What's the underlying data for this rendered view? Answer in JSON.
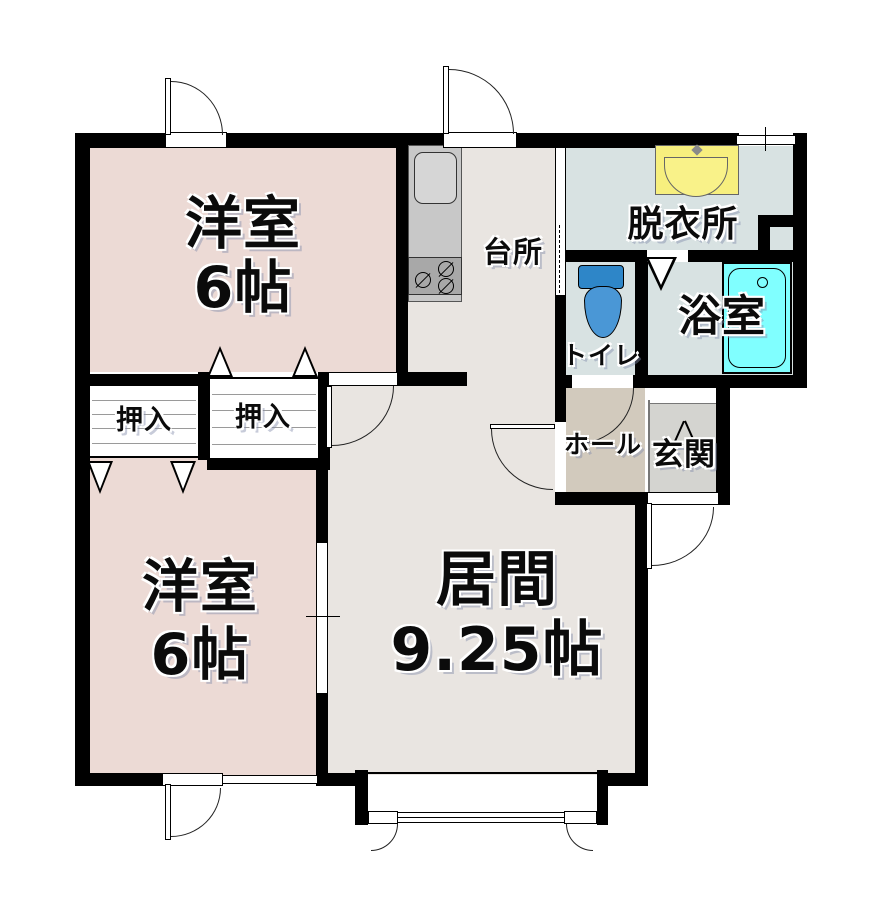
{
  "title": "apartment floor plan",
  "plan_type": "floorplan",
  "rooms": {
    "bedroom_top": {
      "label": "洋室",
      "area": "6帖"
    },
    "bedroom_bottom": {
      "label": "洋室",
      "area": "6帖"
    },
    "living": {
      "label": "居間",
      "area": "9.25帖"
    },
    "kitchen": {
      "label": "台所"
    },
    "dressing": {
      "label": "脱衣所"
    },
    "toilet": {
      "label": "トイレ"
    },
    "bath": {
      "label": "浴室"
    },
    "hall": {
      "label": "ホール"
    },
    "entrance": {
      "label": "玄関"
    },
    "closet_upper": {
      "label": "押入"
    },
    "closet_lower": {
      "label": "押入"
    }
  },
  "fixtures": [
    "kitchen-sink",
    "gas-stove",
    "washbasin",
    "toilet-bowl",
    "bathtub"
  ],
  "colors": {
    "wall": "#000000",
    "bedroom": "#ecdad5",
    "living": "#e9e5e1",
    "wet_room": "#d8e2e2",
    "hall": "#d2cabd",
    "entrance_floor": "#d4d4d0",
    "bathtub": "#80ffff",
    "toilet_tank": "#2e86c8",
    "toilet_bowl": "#4a97d6",
    "basin_yellow": "#f7ef7e",
    "counter_gray": "#c8c8c8",
    "stove_gray": "#a8a8a8"
  }
}
